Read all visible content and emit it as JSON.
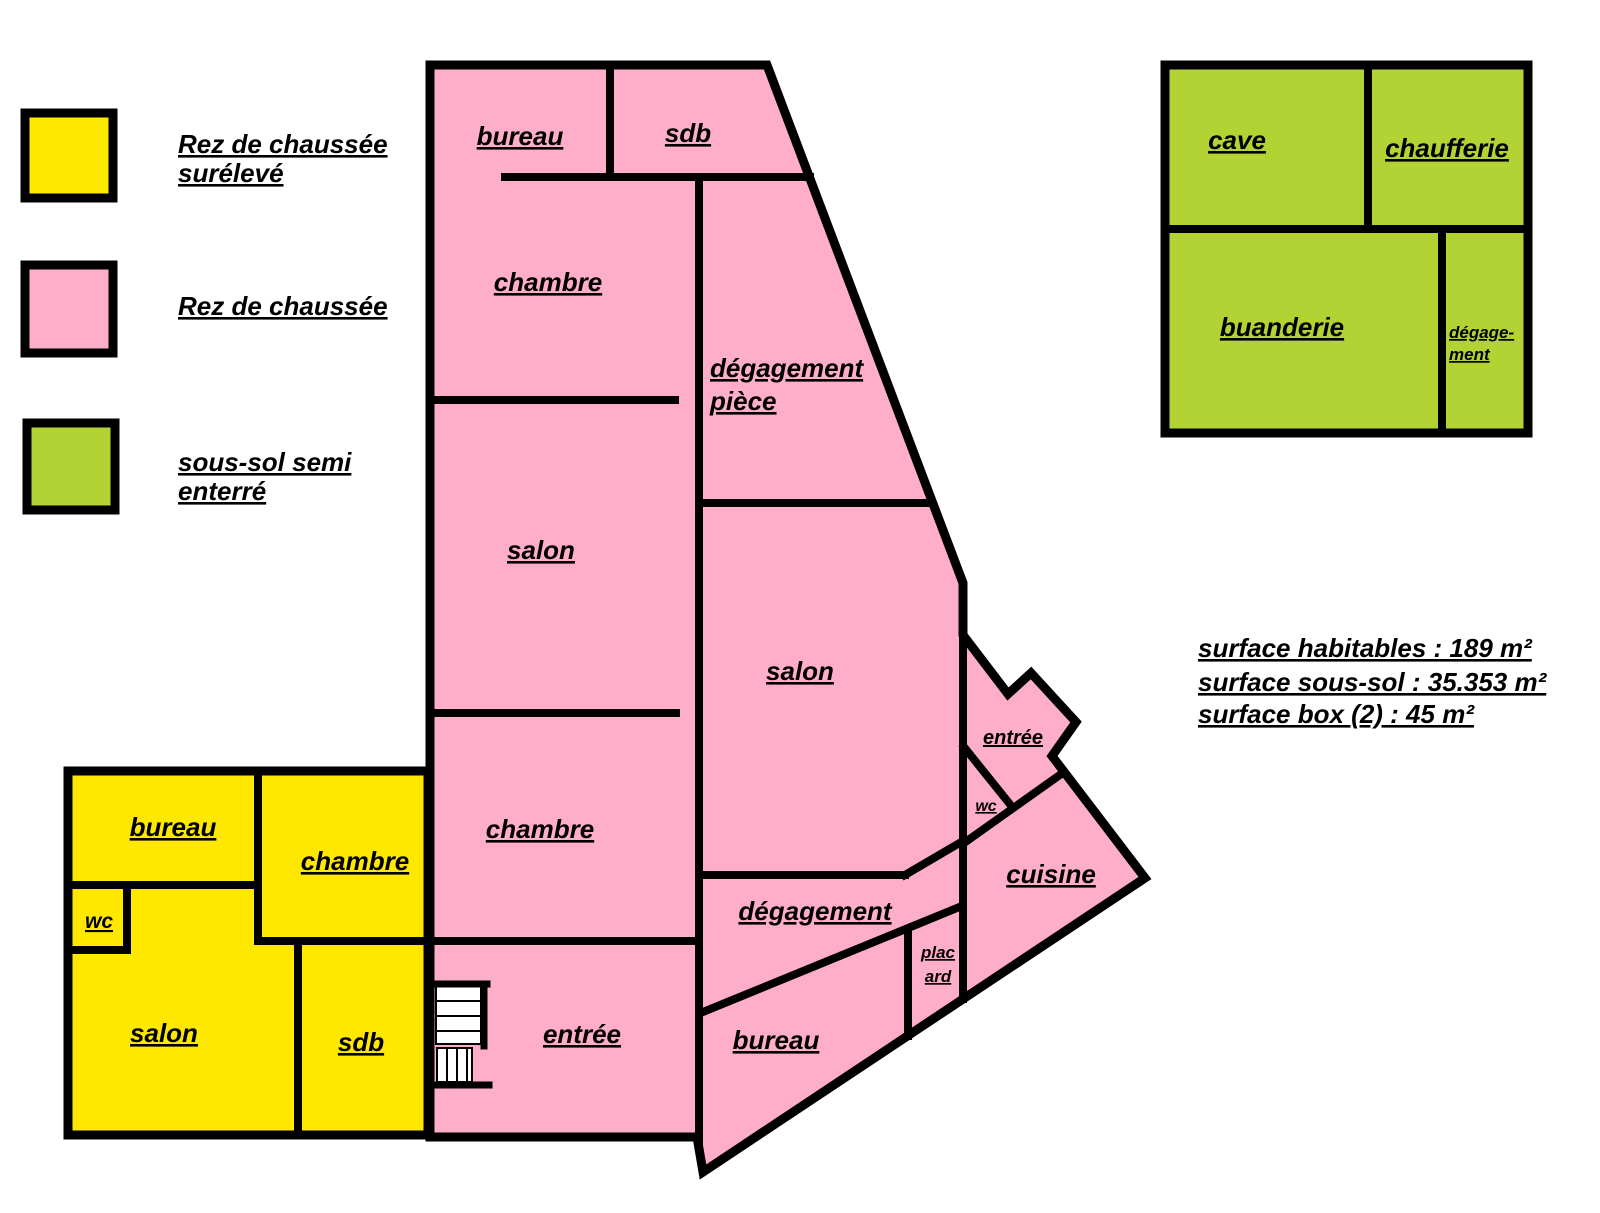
{
  "colors": {
    "rdc_sureleve": "#FFE800",
    "rdc": "#FFAEC9",
    "sous_sol": "#B3D335",
    "walls": "#000000",
    "background": "#FFFFFF"
  },
  "legend": {
    "items": [
      {
        "id": "rdc-sureleve",
        "lines": [
          "Rez de chaussée",
          "surélevé"
        ]
      },
      {
        "id": "rdc",
        "lines": [
          "Rez de chaussée"
        ]
      },
      {
        "id": "sous-sol",
        "lines": [
          "sous-sol semi",
          "enterré"
        ]
      }
    ]
  },
  "plans": {
    "rdc": {
      "rooms": {
        "bureau_top": "bureau",
        "sdb": "sdb",
        "chambre_top": "chambre",
        "degagement_piece": [
          "dégagement",
          "pièce"
        ],
        "salon_left": "salon",
        "salon_right": "salon",
        "chambre_bottom": "chambre",
        "entree": "entrée",
        "entree_hall": "entrée",
        "wc": "wc",
        "cuisine": "cuisine",
        "degagement": "dégagement",
        "placard": [
          "plac",
          "ard"
        ],
        "bureau_bottom": "bureau"
      }
    },
    "rdc_sureleve": {
      "rooms": {
        "bureau": "bureau",
        "chambre": "chambre",
        "wc": "wc",
        "salon": "salon",
        "sdb": "sdb"
      }
    },
    "sous_sol": {
      "rooms": {
        "cave": "cave",
        "chaufferie": "chaufferie",
        "buanderie": "buanderie",
        "degagement": [
          "dégage-",
          "ment"
        ]
      }
    }
  },
  "surfaces": {
    "lines": [
      "surface habitables : 189 m²",
      "surface sous-sol : 35.353 m²",
      "surface box (2) : 45 m²"
    ]
  }
}
